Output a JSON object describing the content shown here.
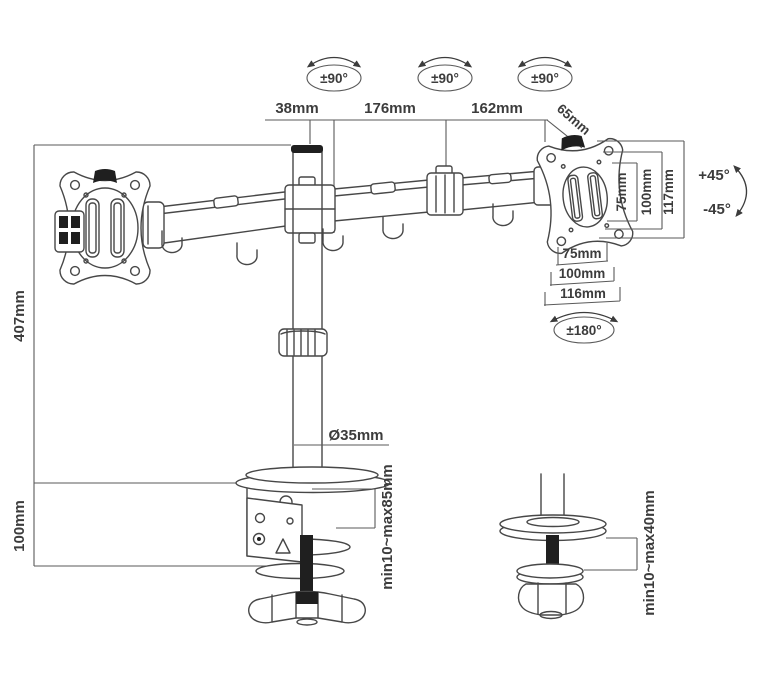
{
  "diagram": {
    "title": "Dual monitor desk mount arm — dimension drawing",
    "colors": {
      "background": "#ffffff",
      "line": "#474747",
      "dim_line": "#5a5a5a",
      "text": "#3c3c3c",
      "dark_fill": "#1f1f1f"
    },
    "annotations": {
      "top_rotation": [
        "±90°",
        "±90°",
        "±90°"
      ],
      "top_dimensions": [
        "38mm",
        "176mm",
        "162mm",
        "65mm"
      ],
      "vesa_vertical": [
        "75mm",
        "100mm",
        "117mm"
      ],
      "tilt": {
        "up": "+45°",
        "down": "-45°"
      },
      "vesa_horizontal": [
        "75mm",
        "100mm",
        "116mm"
      ],
      "swivel": "±180°",
      "pole_diameter": "Ø35mm",
      "pole_height": "407mm",
      "base_height": "100mm",
      "clamp_range": "min10~max85mm",
      "grommet_range": "min10~max40mm"
    }
  }
}
